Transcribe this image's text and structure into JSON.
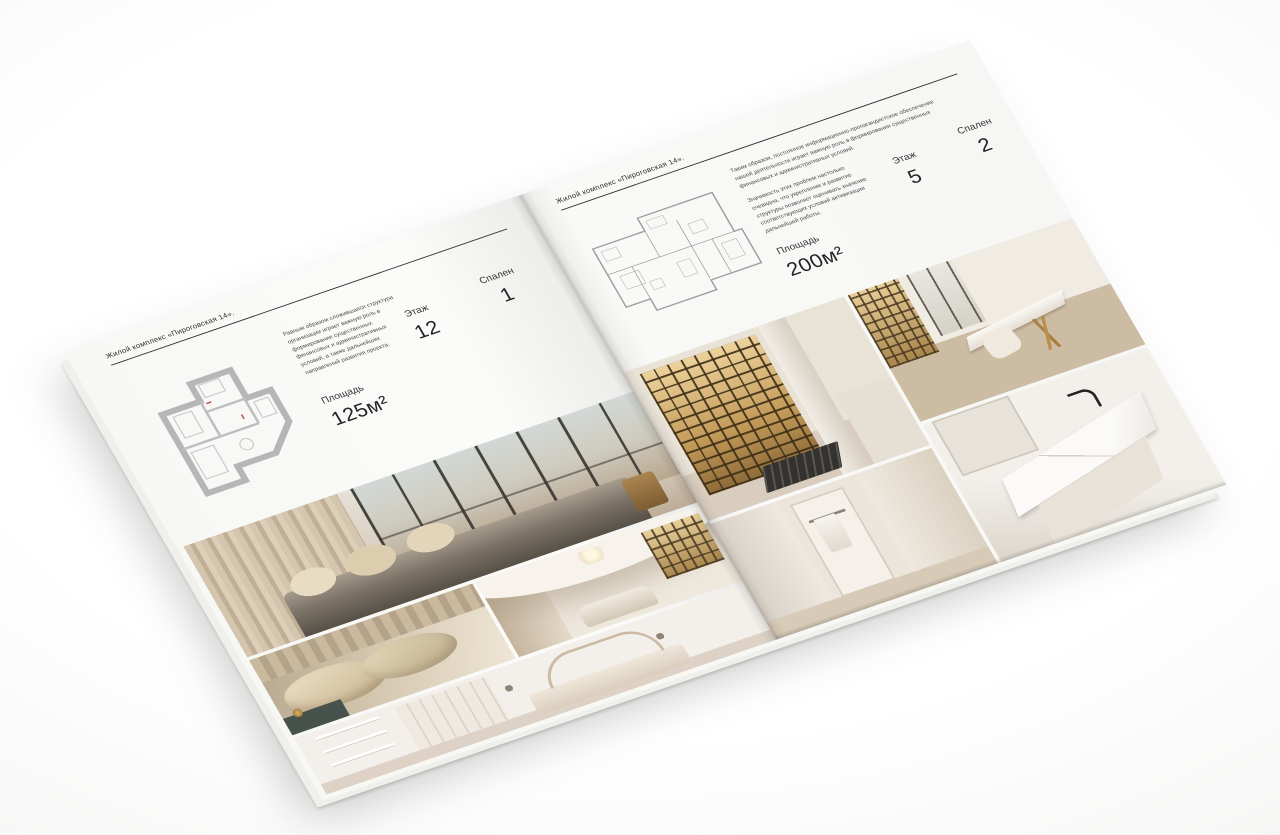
{
  "colors": {
    "paper": "#f8f8f6",
    "ink": "#2d2d2d",
    "photo_warm_beige": "#cbb9a3",
    "shelf_gold": "#c9a05e"
  },
  "page_left": {
    "header": "Жилой комплекс «Пироговская 14».",
    "description": "Равным образом сложившаяся структура организации играет важную роль в формировании существенных финансовых и административных условий, а также дальнейших направлений развития проекта.",
    "area_label": "Площадь",
    "area_value": "125м²",
    "floor_label": "Этаж",
    "floor_value": "12",
    "bedrooms_label": "Спален",
    "bedrooms_value": "1",
    "photos": [
      "bedroom-panorama",
      "bed-pillows-closeup",
      "vaulted-lounge",
      "white-bedroom"
    ]
  },
  "page_right": {
    "header": "Жилой комплекс «Пироговская 14».",
    "description_1": "Таким образом, постоянное информационно-пропагандистское обеспечение нашей деятельности играет важную роль в формировании существенных финансовых и административных условий.",
    "description_2": "Значимость этих проблем настолько очевидна, что укрепление и развитие структуры позволяет оценивать значение соответствующих условий активизации дальнейшей работы.",
    "area_label": "Площадь",
    "area_value": "200м²",
    "floor_label": "Этаж",
    "floor_value": "5",
    "bedrooms_label": "Спален",
    "bedrooms_value": "2",
    "photos": [
      "kitchen-display-cabinets",
      "home-office",
      "hallway",
      "bathroom-sink"
    ]
  }
}
